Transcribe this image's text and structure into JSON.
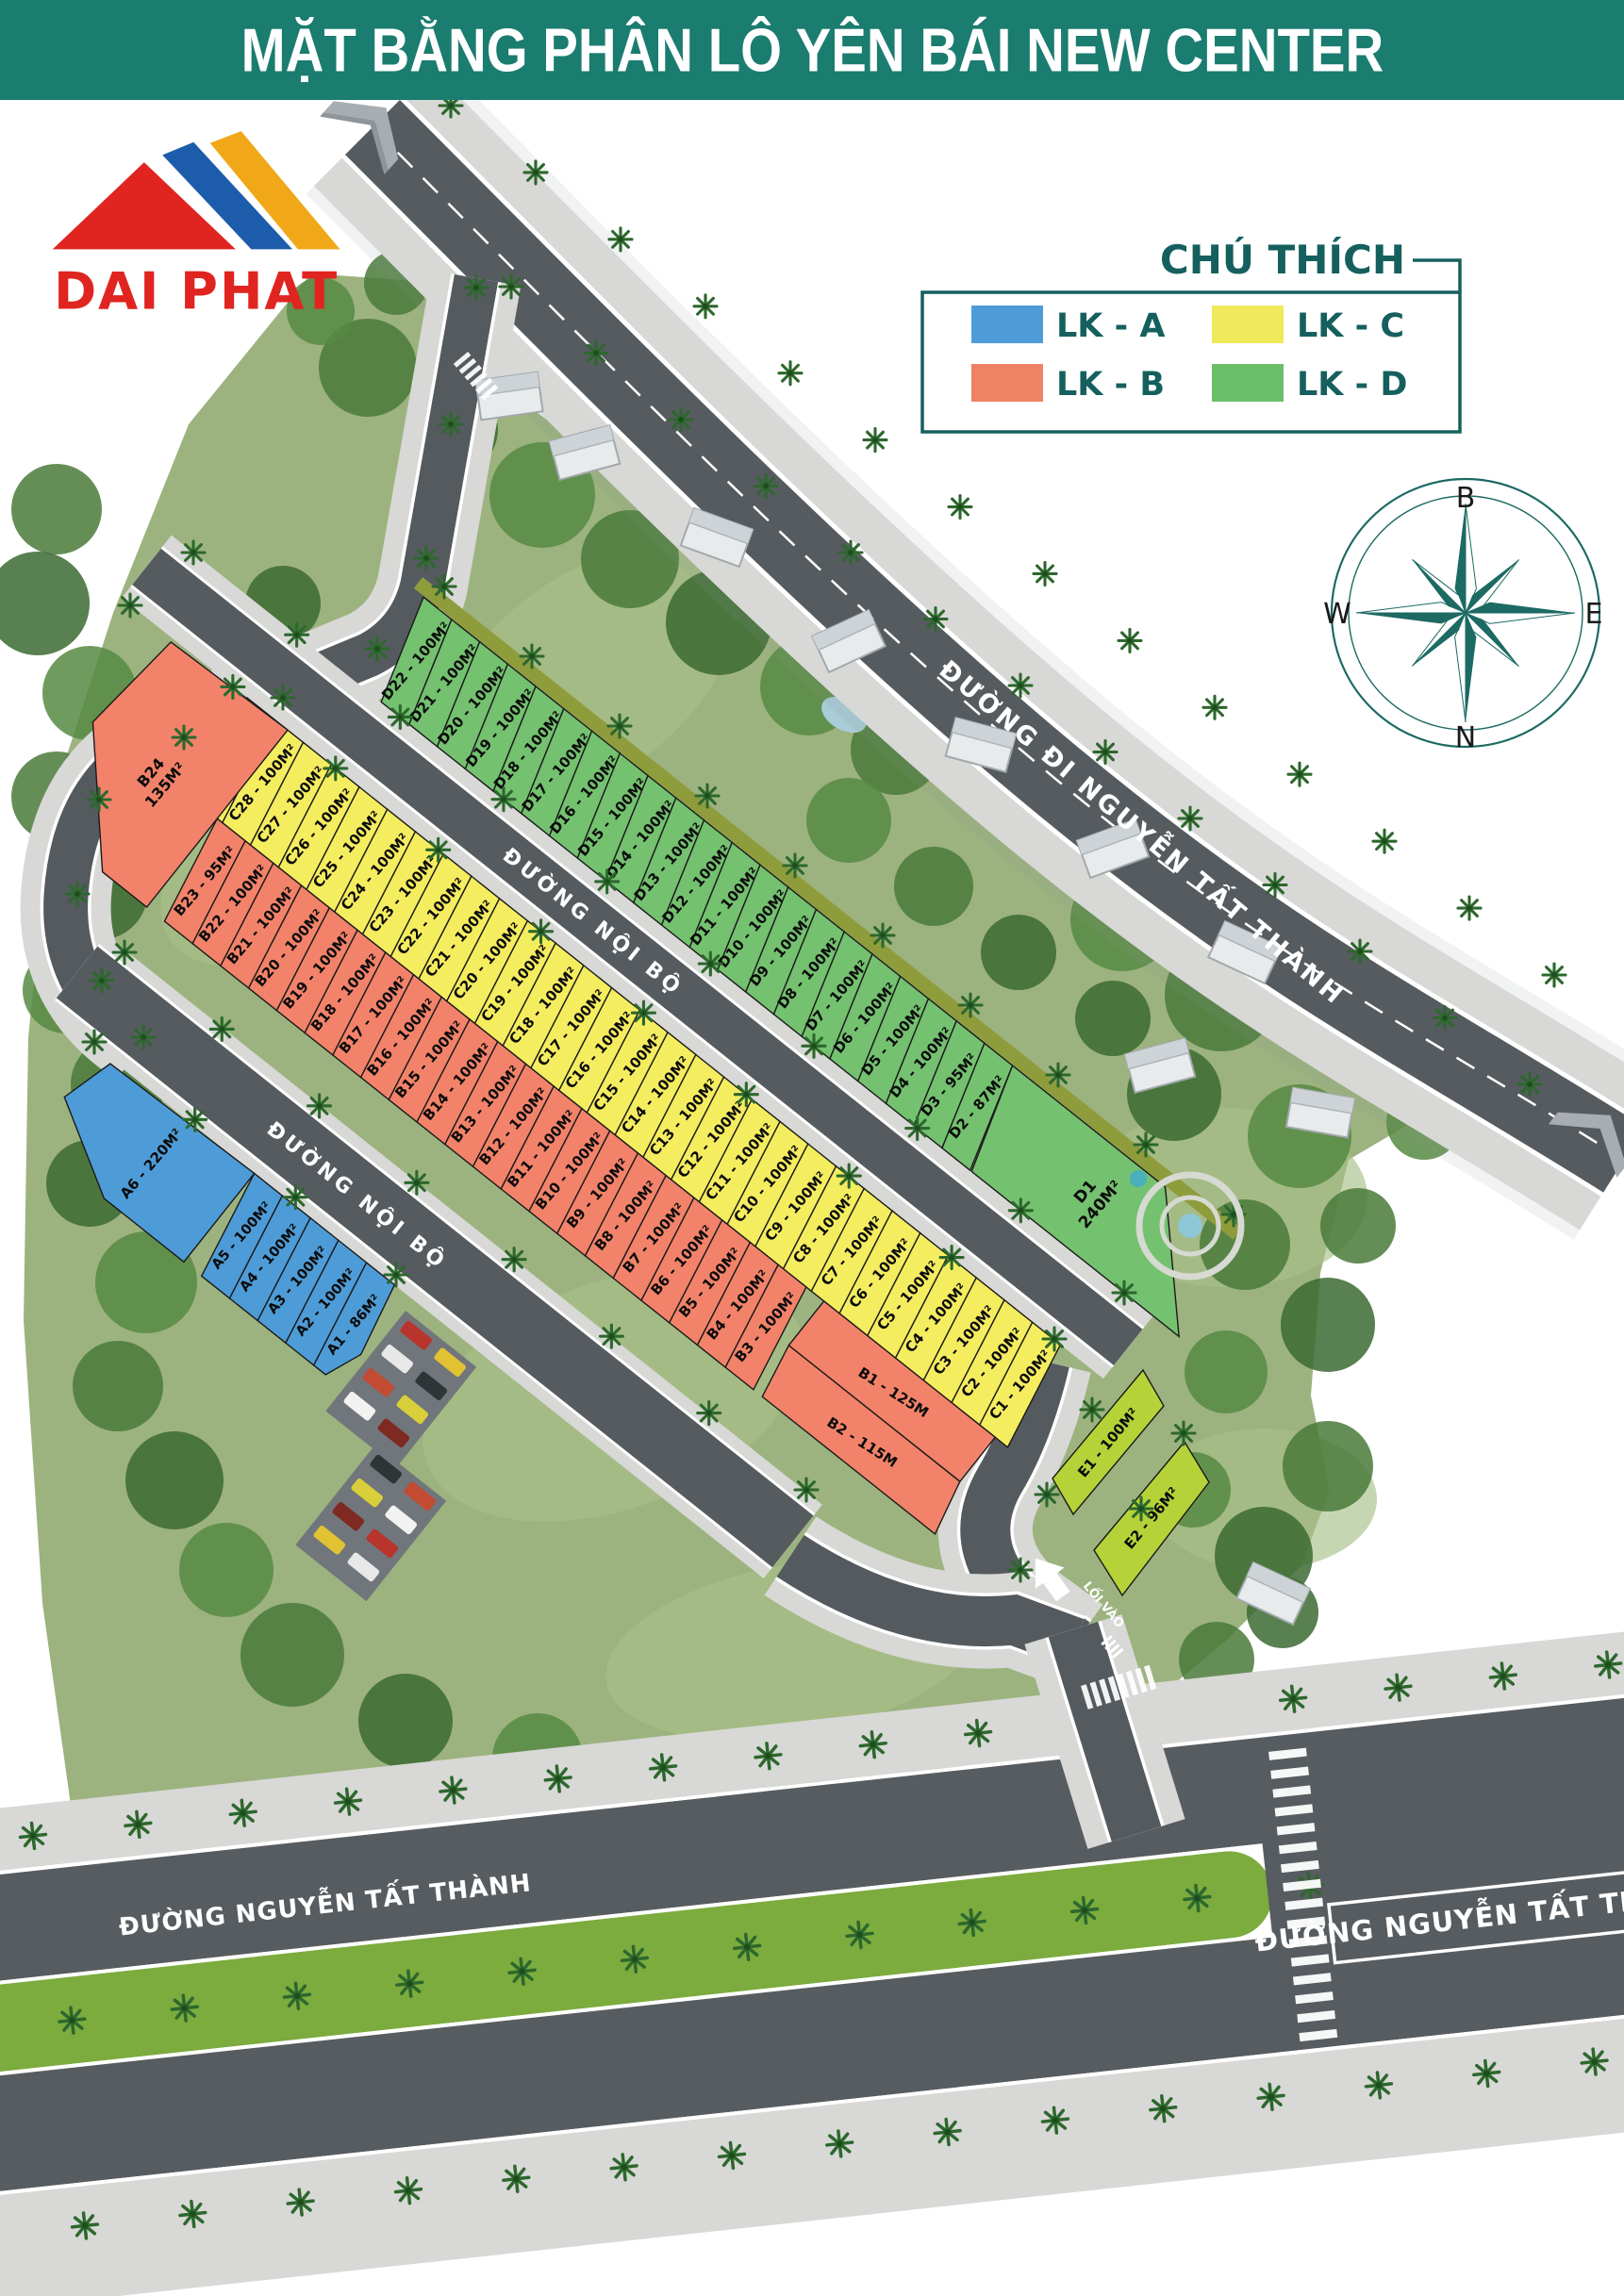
{
  "header": {
    "title": "MẶT BẰNG PHÂN LÔ YÊN BÁI NEW CENTER"
  },
  "logo": {
    "text": "DAI PHAT"
  },
  "legend": {
    "title": "CHÚ THÍCH",
    "items": [
      {
        "label": "LK - A",
        "color": "#4e9cd7"
      },
      {
        "label": "LK - B",
        "color": "#ef8165"
      },
      {
        "label": "LK - C",
        "color": "#f0e95c"
      },
      {
        "label": "LK - D",
        "color": "#6cbf69"
      }
    ]
  },
  "compass": {
    "top": "B",
    "right": "E",
    "bottom": "N",
    "left": "W"
  },
  "roads": {
    "highway_label": "ĐƯỜNG ĐI NGUYỄN TẤT THÀNH",
    "internal_road_label_1": "ĐƯỜNG NỘI BỘ",
    "internal_road_label_2": "ĐƯỜNG NỘI BỘ",
    "main_road_label_left": "ĐƯỜNG NGUYỄN TẤT THÀNH",
    "main_road_label_right": "ĐƯỜNG NGUYỄN TẤT THÀNH",
    "entrance_label": "LỐI VÀO"
  },
  "zones": {
    "A": {
      "name": "LK - A",
      "color": "#4e9cd7",
      "plots": [
        "A6 - 220M²",
        "A5 - 100M²",
        "A4 - 100M²",
        "A3 - 100M²",
        "A2 - 100M²",
        "A1 - 86M²"
      ]
    },
    "B": {
      "name": "LK - B",
      "color": "#f2836a",
      "plots": [
        "B24\n135M²",
        "B23 - 95M²",
        "B22 - 100M²",
        "B21 - 100M²",
        "B20 - 100M²",
        "B19 - 100M²",
        "B18 - 100M²",
        "B17 - 100M²",
        "B16 - 100M²",
        "B15 - 100M²",
        "B14 - 100M²",
        "B13 - 100M²",
        "B12 - 100M²",
        "B11 - 100M²",
        "B10 - 100M²",
        "B9 - 100M²",
        "B8 - 100M²",
        "B7 - 100M²",
        "B6 - 100M²",
        "B5 - 100M²",
        "B4 - 100M²",
        "B3 - 100M²",
        "B1 - 125M",
        "B2 - 115M"
      ]
    },
    "C": {
      "name": "LK - C",
      "color": "#f5ed60",
      "plots": [
        "C29 - 100M²",
        "C28 - 100M²",
        "C27 - 100M²",
        "C26 - 100M²",
        "C25 - 100M²",
        "C24 - 100M²",
        "C23 - 100M²",
        "C22 - 100M²",
        "C21 - 100M²",
        "C20 - 100M²",
        "C19 - 100M²",
        "C18 - 100M²",
        "C17 - 100M²",
        "C16 - 100M²",
        "C15 - 100M²",
        "C14 - 100M²",
        "C13 - 100M²",
        "C12 - 100M²",
        "C11 - 100M²",
        "C10 - 100M²",
        "C9 - 100M²",
        "C8 - 100M²",
        "C7 - 100M²",
        "C6 - 100M²",
        "C5 - 100M²",
        "C4 - 100M²",
        "C3 - 100M²",
        "C2 - 100M²",
        "C1 - 100M²"
      ]
    },
    "D": {
      "name": "LK - D",
      "color": "#74c170",
      "plots": [
        "D22 - 100M²",
        "D21 - 100M²",
        "D20 - 100M²",
        "D19 - 100M²",
        "D18 - 100M²",
        "D17 - 100M²",
        "D16 - 100M²",
        "D15 - 100M²",
        "D14 - 100M²",
        "D13 - 100M²",
        "D12 - 100M²",
        "D11 - 100M²",
        "D10 - 100M²",
        "D9 - 100M²",
        "D8 - 100M²",
        "D7 - 100M²",
        "D6 - 100M²",
        "D5 - 100M²",
        "D4 - 100M²",
        "D3 - 95M²",
        "D2 - 87M²",
        "D1\n240M²"
      ]
    },
    "E": {
      "name": "E",
      "color": "#b5d338",
      "plots": [
        "E1 - 100M²",
        "E2 - 96M²"
      ]
    }
  }
}
